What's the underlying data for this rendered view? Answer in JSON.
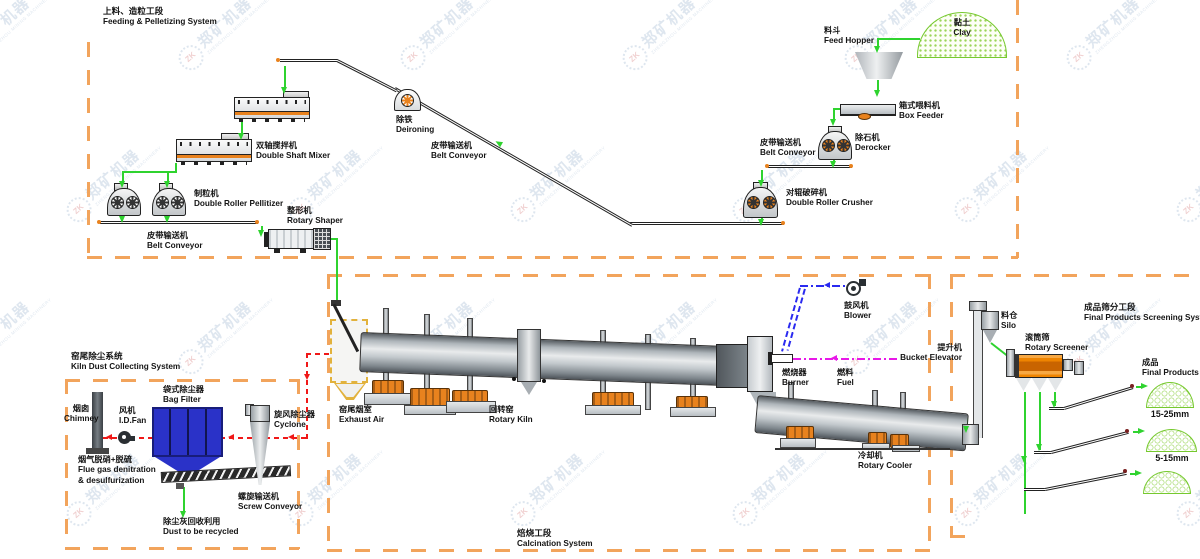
{
  "watermark": {
    "gear_text": "ZK",
    "name": "郑矿机器",
    "sub": "ZHENGZHOU MINING MACHINERY"
  },
  "colors": {
    "section_border_orange": "#f2a45c",
    "flow_green": "#2fd32f",
    "flue_gas_red": "#f01818",
    "air_blue": "#2a2af0",
    "fuel_magenta": "#e818e8",
    "bag_filter_blue": "#2a32c8",
    "screener_orange": "#ef8400",
    "support_orange": "#e8821e",
    "product_green": "#76c92e",
    "watermark_blue": "#bfcfe0"
  },
  "sections": {
    "feeding": {
      "zh": "上料、造粒工段",
      "en": "Feeding & Pelletizing System"
    },
    "calcination": {
      "zh": "焙烧工段",
      "en": "Calcination System"
    },
    "dust": {
      "zh": "窑尾除尘系统",
      "en": "Kiln Dust Collecting System"
    },
    "screening": {
      "zh": "成品筛分工段",
      "en": "Final Products Screening System"
    }
  },
  "labels": {
    "clay": {
      "zh": "黏土",
      "en": "Clay"
    },
    "feed_hopper": {
      "zh": "料斗",
      "en": "Feed Hopper"
    },
    "box_feeder": {
      "zh": "箱式喂料机",
      "en": "Box Feeder"
    },
    "derocker": {
      "zh": "除石机",
      "en": "Derocker"
    },
    "belt_conveyor": {
      "zh": "皮带输送机",
      "en": "Belt Conveyor"
    },
    "crusher": {
      "zh": "对辊破碎机",
      "en": "Double Roller Crusher"
    },
    "deironing": {
      "zh": "除铁",
      "en": "Deironing"
    },
    "mixer": {
      "zh": "双轴搅拌机",
      "en": "Double Shaft Mixer"
    },
    "pelletizer": {
      "zh": "制粒机",
      "en": "Double Roller Pellitizer"
    },
    "shaper": {
      "zh": "整形机",
      "en": "Rotary Shaper"
    },
    "exhaust_air": {
      "zh": "窑尾烟室",
      "en": "Exhaust Air"
    },
    "rotary_kiln": {
      "zh": "回转窑",
      "en": "Rotary Kiln"
    },
    "blower": {
      "zh": "鼓风机",
      "en": "Blower"
    },
    "burner": {
      "zh": "燃烧器",
      "en": "Burner"
    },
    "fuel": {
      "zh": "燃料",
      "en": "Fuel"
    },
    "bucket_elevator": {
      "zh": "提升机",
      "en": "Bucket Elevator"
    },
    "rotary_cooler": {
      "zh": "冷却机",
      "en": "Rotary Cooler"
    },
    "chimney": {
      "zh": "烟囱",
      "en": "Chimney"
    },
    "id_fan": {
      "zh": "风机",
      "en": "I.D.Fan"
    },
    "bag_filter": {
      "zh": "袋式除尘器",
      "en": "Bag Filter"
    },
    "cyclone": {
      "zh": "旋风除尘器",
      "en": "Cyclone"
    },
    "flue_gas": {
      "zh": "烟气脱硝+脱硫",
      "en": "Flue gas denitration & desulfurization"
    },
    "screw_conveyor": {
      "zh": "螺旋输送机",
      "en": "Screw Conveyor"
    },
    "dust_recycled": {
      "zh": "除尘灰回收利用",
      "en": "Dust to be recycled"
    },
    "silo": {
      "zh": "料仓",
      "en": "Silo"
    },
    "rotary_screener": {
      "zh": "滚筒筛",
      "en": "Rotary Screener"
    },
    "final_products": {
      "zh": "成品",
      "en": "Final Products"
    }
  },
  "products": {
    "size_large": "15-25mm",
    "size_small": "5-15mm"
  }
}
